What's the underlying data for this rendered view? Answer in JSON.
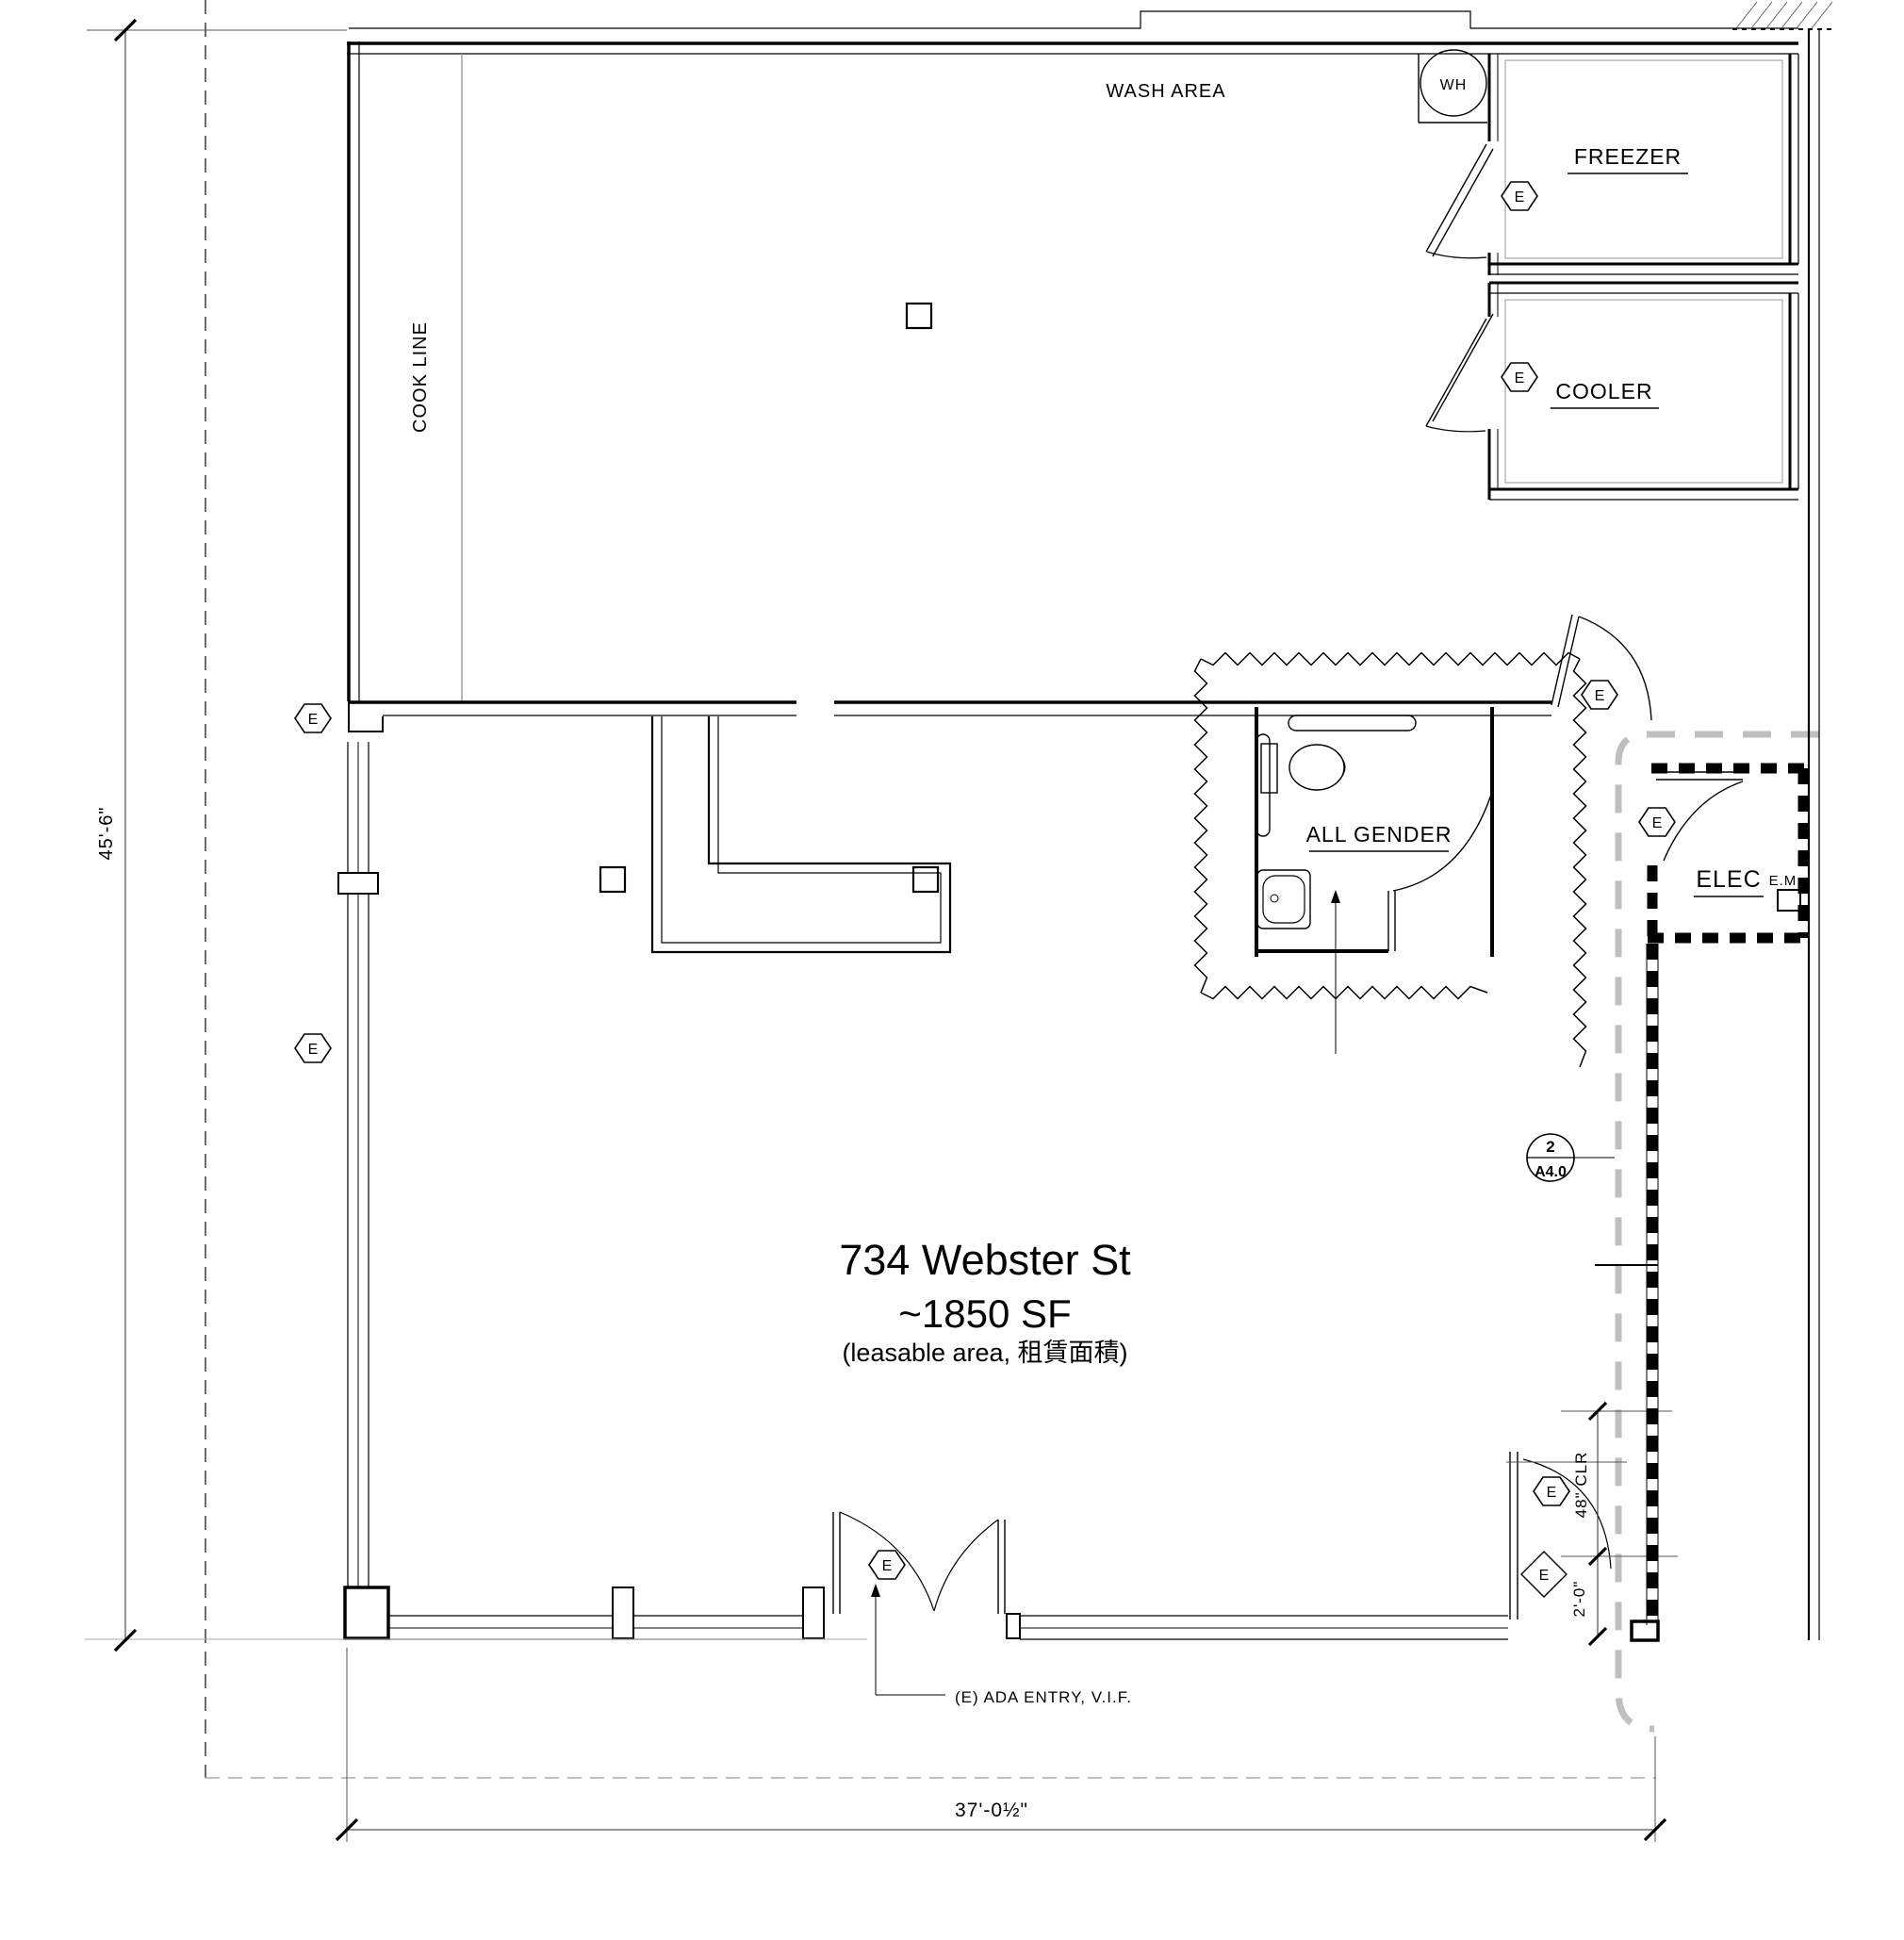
{
  "drawing": {
    "address": "734 Webster St",
    "area": "~1850 SF",
    "area_note": "(leasable area, 租賃面積)"
  },
  "rooms": {
    "wash_area": "WASH AREA",
    "cook_line": "COOK LINE",
    "freezer": "FREEZER",
    "cooler": "COOLER",
    "restroom": "ALL GENDER",
    "electrical": "ELEC",
    "electrical_meter": "E.M.",
    "water_heater": "WH"
  },
  "dimensions": {
    "left_overall": "45'-6\"",
    "bottom_overall": "37'-0½\"",
    "door_clearance": "48\" CLR",
    "door_offset": "2'-0\""
  },
  "annotations": {
    "ada_entry": "(E) ADA ENTRY, V.I.F.",
    "existing_symbol": "E",
    "detail_callout": {
      "number": "2",
      "sheet": "A4.0"
    }
  }
}
